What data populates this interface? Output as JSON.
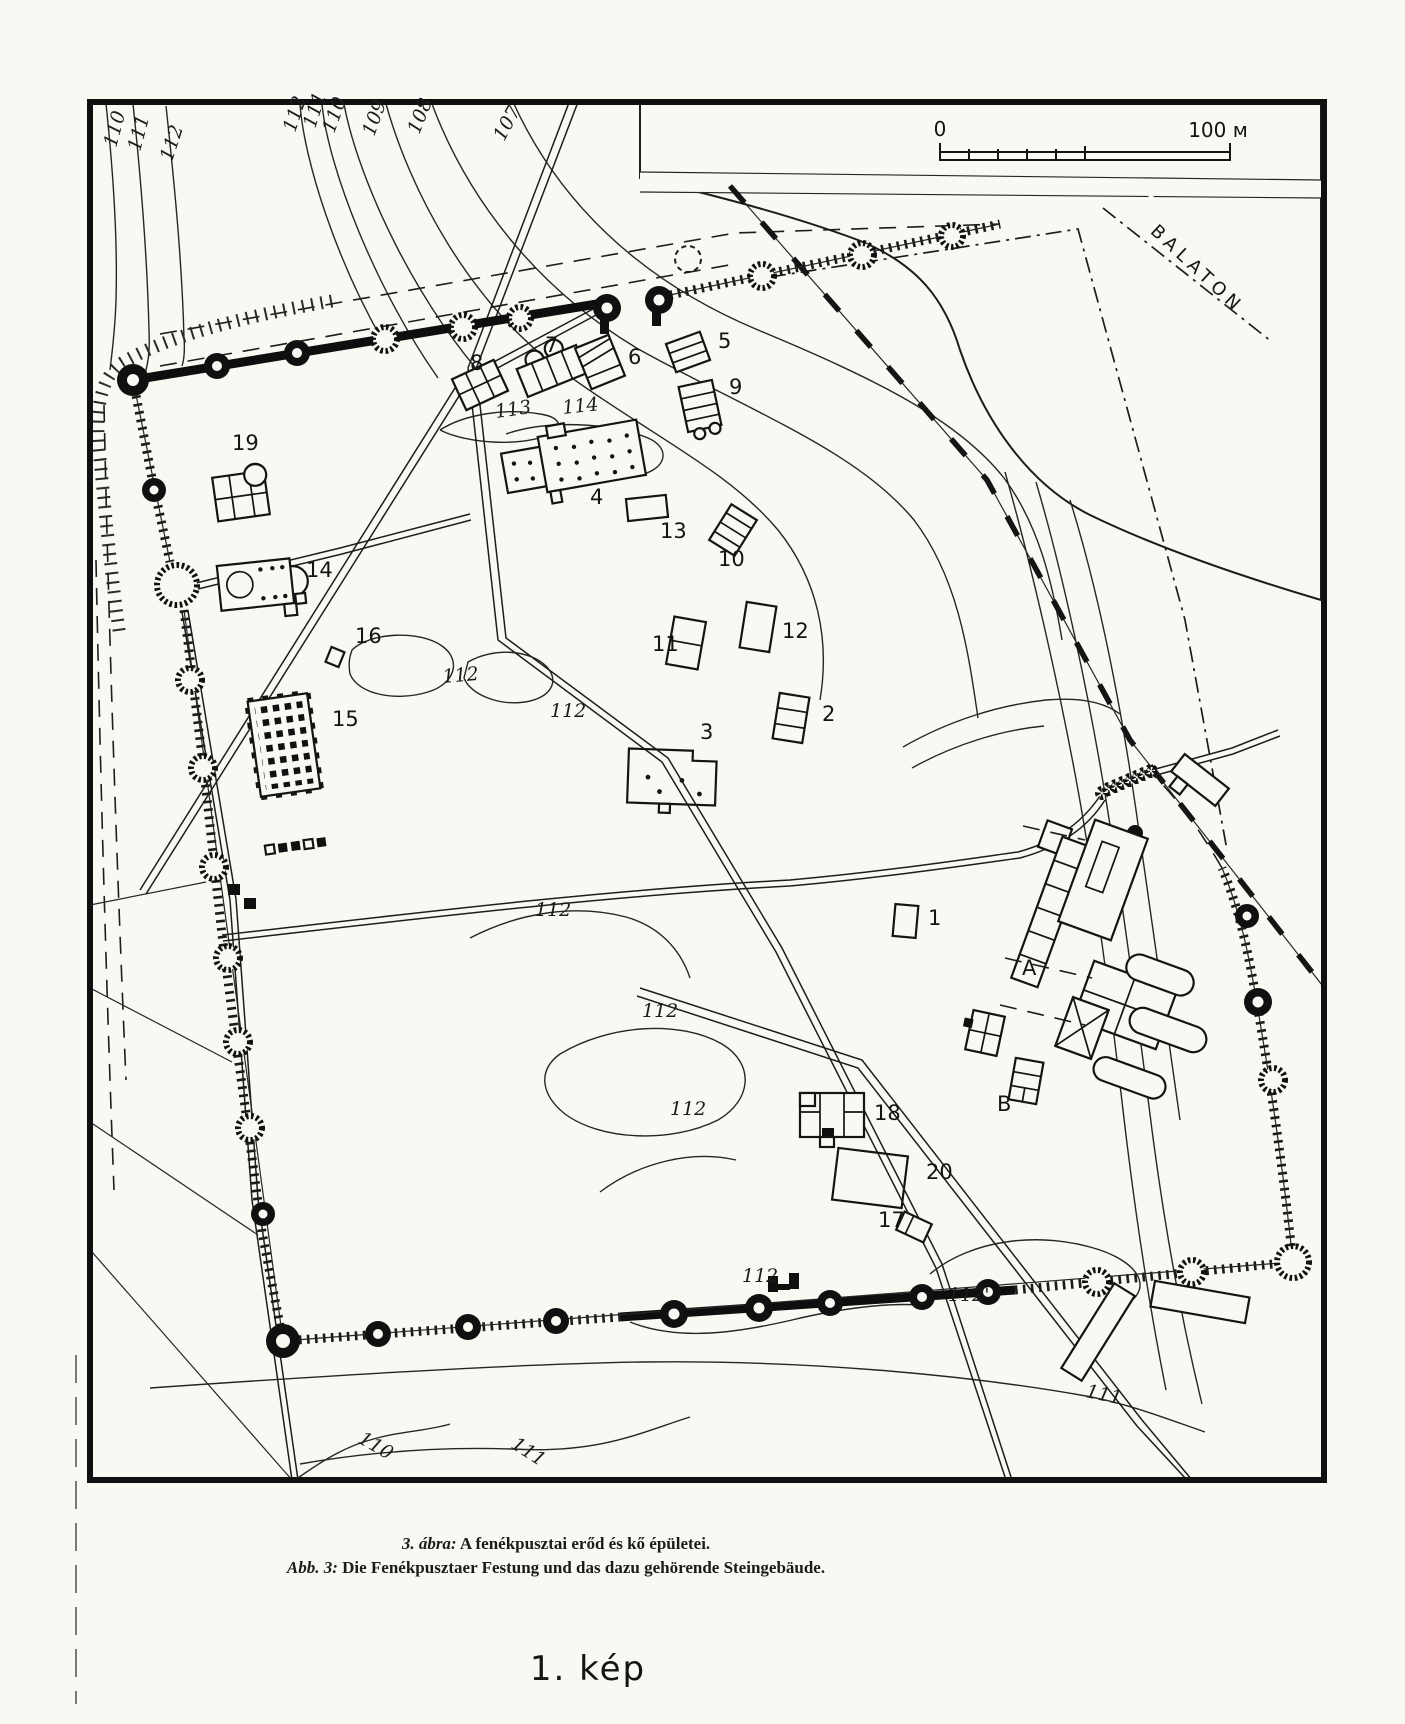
{
  "figure": {
    "caption_line1_prefix": "3. ábra:",
    "caption_line1_text": " A fenékpusztai erőd és kő épületei.",
    "caption_line2_prefix": "Abb. 3:",
    "caption_line2_text": " Die Fenékpusztaer Festung und das dazu gehörende Steingebäude.",
    "plate_label": "1. kép"
  },
  "map": {
    "water_label": "BALATON",
    "scale_bar": {
      "start_label": "0",
      "end_label": "100 м"
    },
    "building_labels": [
      {
        "text": "19",
        "x": 232,
        "y": 450
      },
      {
        "text": "8",
        "x": 470,
        "y": 370
      },
      {
        "text": "7",
        "x": 545,
        "y": 352
      },
      {
        "text": "6",
        "x": 628,
        "y": 364
      },
      {
        "text": "5",
        "x": 718,
        "y": 348
      },
      {
        "text": "9",
        "x": 729,
        "y": 394
      },
      {
        "text": "4",
        "x": 590,
        "y": 504
      },
      {
        "text": "13",
        "x": 660,
        "y": 538
      },
      {
        "text": "10",
        "x": 718,
        "y": 566
      },
      {
        "text": "14",
        "x": 306,
        "y": 577
      },
      {
        "text": "16",
        "x": 355,
        "y": 643
      },
      {
        "text": "11",
        "x": 652,
        "y": 651
      },
      {
        "text": "12",
        "x": 782,
        "y": 638
      },
      {
        "text": "15",
        "x": 332,
        "y": 726
      },
      {
        "text": "2",
        "x": 822,
        "y": 721
      },
      {
        "text": "3",
        "x": 700,
        "y": 739
      },
      {
        "text": "1",
        "x": 928,
        "y": 925
      },
      {
        "text": "A",
        "x": 1022,
        "y": 975
      },
      {
        "text": "18",
        "x": 874,
        "y": 1120
      },
      {
        "text": "B",
        "x": 997,
        "y": 1111
      },
      {
        "text": "20",
        "x": 926,
        "y": 1179
      },
      {
        "text": "17",
        "x": 878,
        "y": 1227
      }
    ],
    "contour_labels": [
      {
        "text": "110",
        "x": 116,
        "y": 148,
        "rot": -75
      },
      {
        "text": "111",
        "x": 140,
        "y": 152,
        "rot": -75
      },
      {
        "text": "112",
        "x": 172,
        "y": 162,
        "rot": -72
      },
      {
        "text": "112",
        "x": 295,
        "y": 133,
        "rot": -72
      },
      {
        "text": "111",
        "x": 315,
        "y": 129,
        "rot": -72
      },
      {
        "text": "110",
        "x": 334,
        "y": 134,
        "rot": -70
      },
      {
        "text": "109",
        "x": 374,
        "y": 137,
        "rot": -70
      },
      {
        "text": "108",
        "x": 419,
        "y": 135,
        "rot": -68
      },
      {
        "text": "107",
        "x": 504,
        "y": 142,
        "rot": -62
      },
      {
        "text": "113",
        "x": 496,
        "y": 418,
        "rot": -8
      },
      {
        "text": "114",
        "x": 563,
        "y": 414,
        "rot": -6
      },
      {
        "text": "112",
        "x": 443,
        "y": 683,
        "rot": -5
      },
      {
        "text": "112",
        "x": 550,
        "y": 717,
        "rot": 0
      },
      {
        "text": "112",
        "x": 535,
        "y": 916,
        "rot": 0
      },
      {
        "text": "112",
        "x": 642,
        "y": 1017,
        "rot": 0
      },
      {
        "text": "112",
        "x": 670,
        "y": 1115,
        "rot": 0
      },
      {
        "text": "112",
        "x": 742,
        "y": 1282,
        "rot": 0
      },
      {
        "text": "112'",
        "x": 948,
        "y": 1301,
        "rot": 0
      },
      {
        "text": "111",
        "x": 1085,
        "y": 1397,
        "rot": 12
      },
      {
        "text": "111",
        "x": 510,
        "y": 1447,
        "rot": 33
      },
      {
        "text": "110",
        "x": 357,
        "y": 1442,
        "rot": 30
      }
    ]
  }
}
